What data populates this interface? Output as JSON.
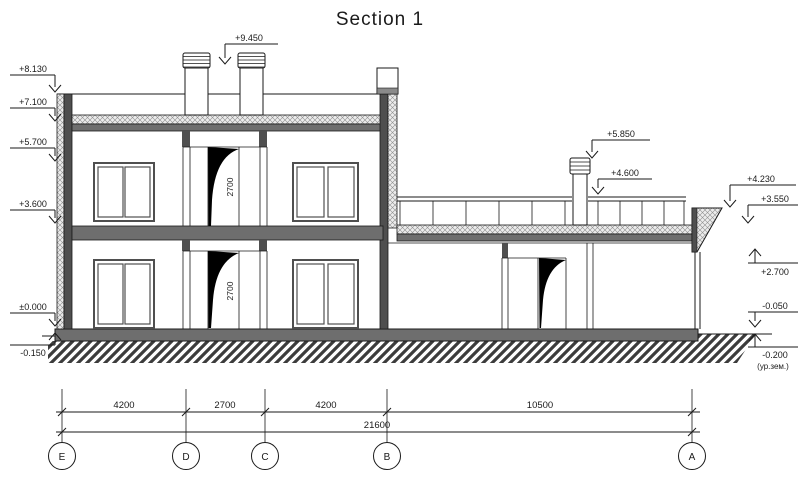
{
  "title": "Section 1",
  "levels": {
    "chimney_top": "+9.450",
    "parapet_top": "+8.130",
    "roof_top": "+7.100",
    "second_window_head": "+5.700",
    "second_floor": "+3.600",
    "ground_floor": "±0.000",
    "ground_level_left": "-0.150",
    "terrace_chimney_top": "+5.850",
    "terrace_railing_top": "+4.600",
    "terrace_parapet_top": "+4.230",
    "terrace_roof_top": "+3.550",
    "one_storey_ceiling": "+2.700",
    "one_storey_floor": "-0.050",
    "ground_level_right": "-0.200",
    "ground_level_right_note": "(ур.зем.)"
  },
  "door_heights": {
    "second_floor_door": "2700",
    "first_floor_door": "2700"
  },
  "dimensions": {
    "e_d": "4200",
    "d_c": "2700",
    "c_b": "4200",
    "b_a": "10500",
    "total": "21600"
  },
  "grid_axes": {
    "e": "E",
    "d": "D",
    "c": "C",
    "b": "B",
    "a": "A"
  },
  "colors": {
    "line": "#1a1a1a",
    "wall_fill": "#4f4f4f",
    "slab_fill": "#6e6e6e"
  }
}
